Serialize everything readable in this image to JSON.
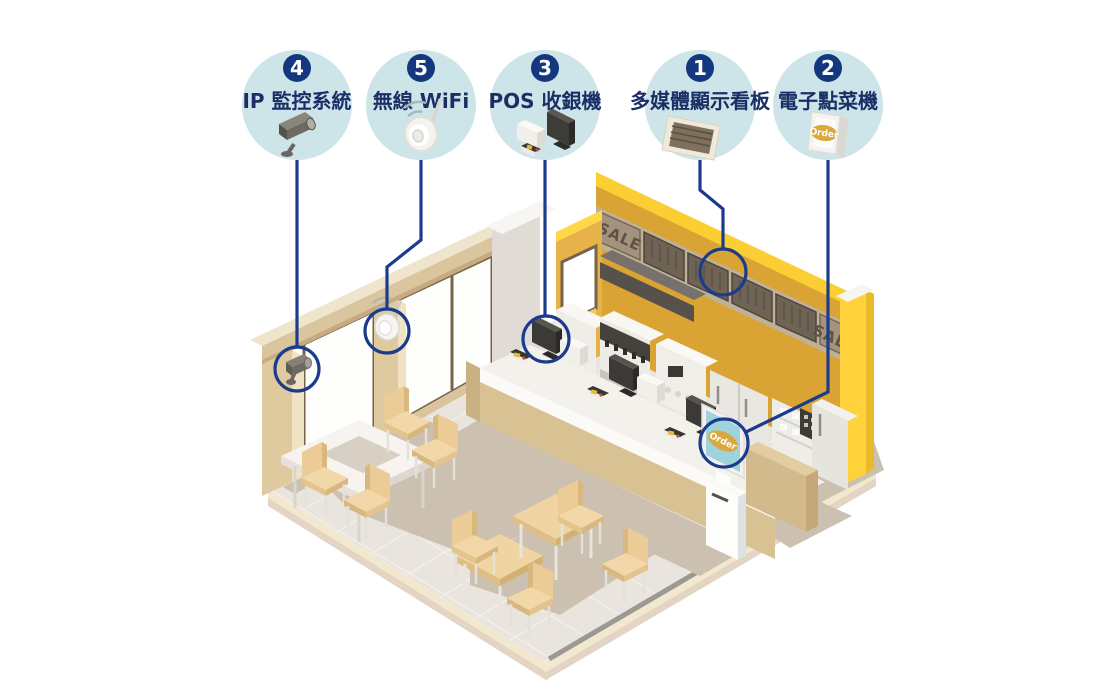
{
  "diagram": {
    "callouts": [
      {
        "number": "4",
        "label": "IP 監控系統",
        "icon": "cctv-camera"
      },
      {
        "number": "5",
        "label": "無線 WiFi",
        "icon": "wifi-access-point"
      },
      {
        "number": "3",
        "label": "POS 收銀機",
        "icon": "pos-register"
      },
      {
        "number": "1",
        "label": "多媒體顯示看板",
        "icon": "menu-display-board"
      },
      {
        "number": "2",
        "label": "電子點菜機",
        "icon": "order-kiosk"
      }
    ],
    "scene": {
      "sale_sign_left": "SALE",
      "sale_sign_right": "SALE",
      "kiosk_screen_text": "Order",
      "kiosk_icon_text": "Order"
    },
    "colors": {
      "accent_navy": "#1B3C8C",
      "callout_circle_fill": "#CDE4E9",
      "badge_fill": "#14387F",
      "label_text": "#1B2F66",
      "wall_yellow": "#D9A433",
      "wall_yellow_light": "#E6B24A",
      "wall_yellow_trim": "#FFD23C",
      "menu_panel_dark": "#6E6354",
      "sale_panel": "#A3937C",
      "counter_tan": "#D8C193",
      "furniture_tan": "#F0D5A2",
      "floor": "#E9E5DE",
      "shadow": "#CCC0B1",
      "kiosk_screen_blue": "#9ED2DC",
      "order_badge": "#D9A93F"
    }
  }
}
